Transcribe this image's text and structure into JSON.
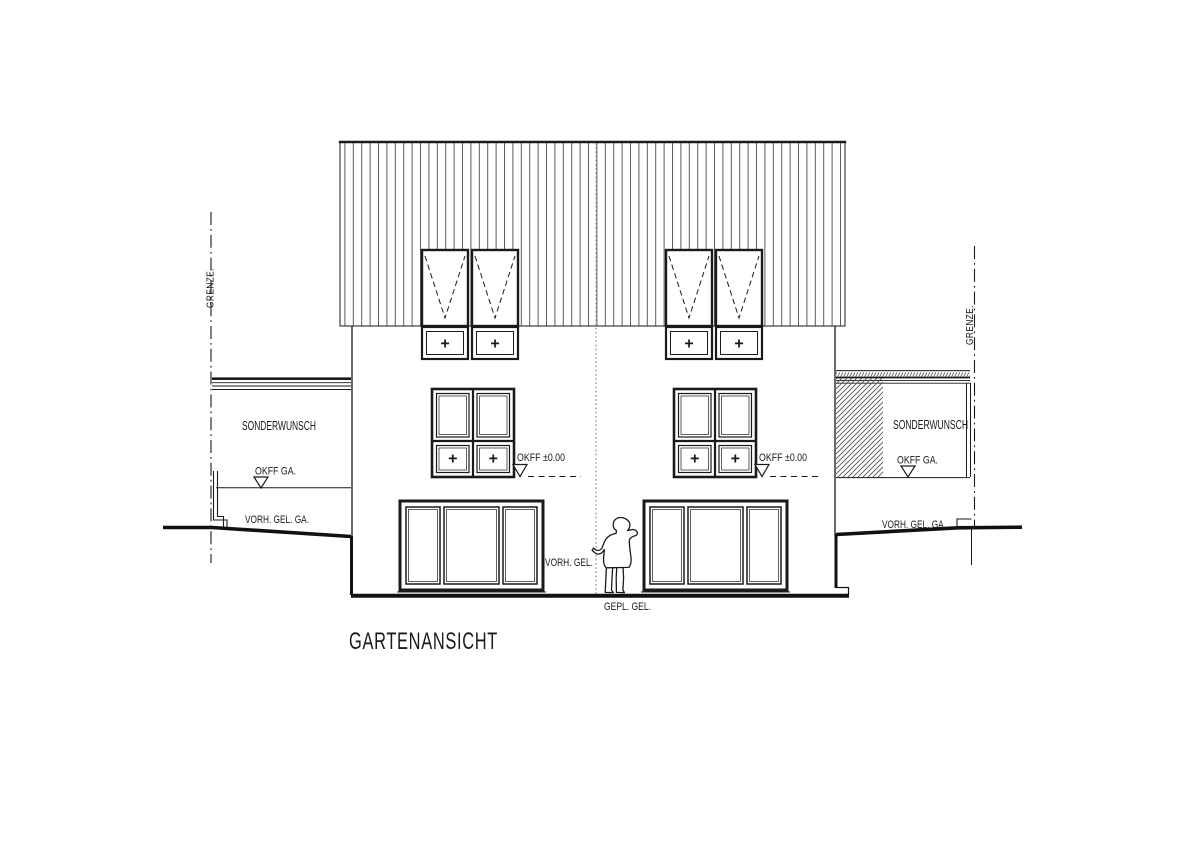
{
  "page": {
    "background": "#ffffff"
  },
  "drawing": {
    "title": "GARTENANSICHT",
    "colors": {
      "line": "#1a1a1a",
      "hatch": "#4a4a4a",
      "centerline": "#9a9a9a",
      "background": "#ffffff"
    },
    "labels": {
      "grenze_left": "GRENZE.",
      "grenze_right": "GRENZE.",
      "sonderwunsch_left": "SONDERWUNSCH",
      "sonderwunsch_right": "SONDERWUNSCH",
      "okff_ga_left": "OKFF GA.",
      "okff_ga_right": "OKFF GA.",
      "vorh_gel_ga_left": "VORH. GEL. GA.",
      "vorh_gel_ga_right": "VORH. GEL. GA.",
      "okff_main_left": "OKFF ±0.00",
      "okff_main_right": "OKFF ±0.00",
      "vorh_gel": "VORH. GEL.",
      "gepl_gel": "GEPL. GEL."
    },
    "symbols": {
      "window_plus": "+"
    }
  }
}
